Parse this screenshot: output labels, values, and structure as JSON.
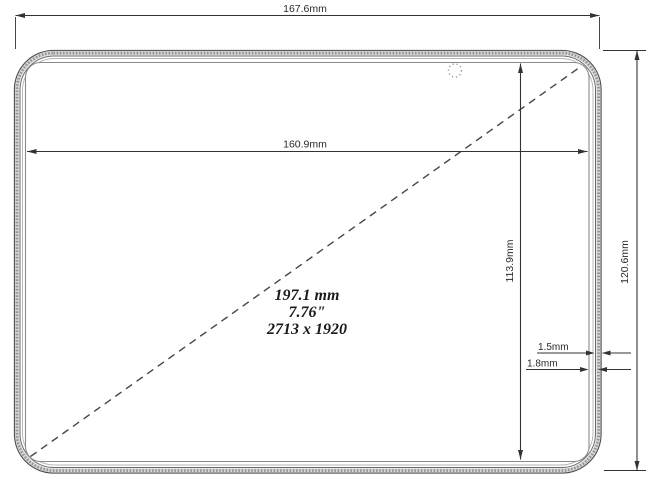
{
  "diagram": {
    "description": "Tablet device dimensional drawing, front view",
    "labels": {
      "outer_width": "167.6mm",
      "screen_width": "160.9mm",
      "screen_height": "113.9mm",
      "outer_height": "120.6mm",
      "gap_small": "1.5mm",
      "gap_large": "1.8mm",
      "diagonal_mm": "197.1 mm",
      "diagonal_inch": "7.76\"",
      "resolution": "2713 x 1920"
    },
    "values": {
      "outer_width_mm": 167.6,
      "outer_height_mm": 120.6,
      "screen_width_mm": 160.9,
      "screen_height_mm": 113.9,
      "bezel_gap_1_mm": 1.5,
      "bezel_gap_2_mm": 1.8,
      "diagonal_mm": 197.1,
      "diagonal_inch": 7.76,
      "resolution_px": "2713 x 1920"
    },
    "colors": {
      "background": "#ffffff",
      "line": "#3d3d3d",
      "band_fill": "#d4d4d4",
      "band_dots": "#8f8f8f",
      "text": "#222222"
    },
    "icons": {
      "camera": "dotted-circle"
    }
  }
}
